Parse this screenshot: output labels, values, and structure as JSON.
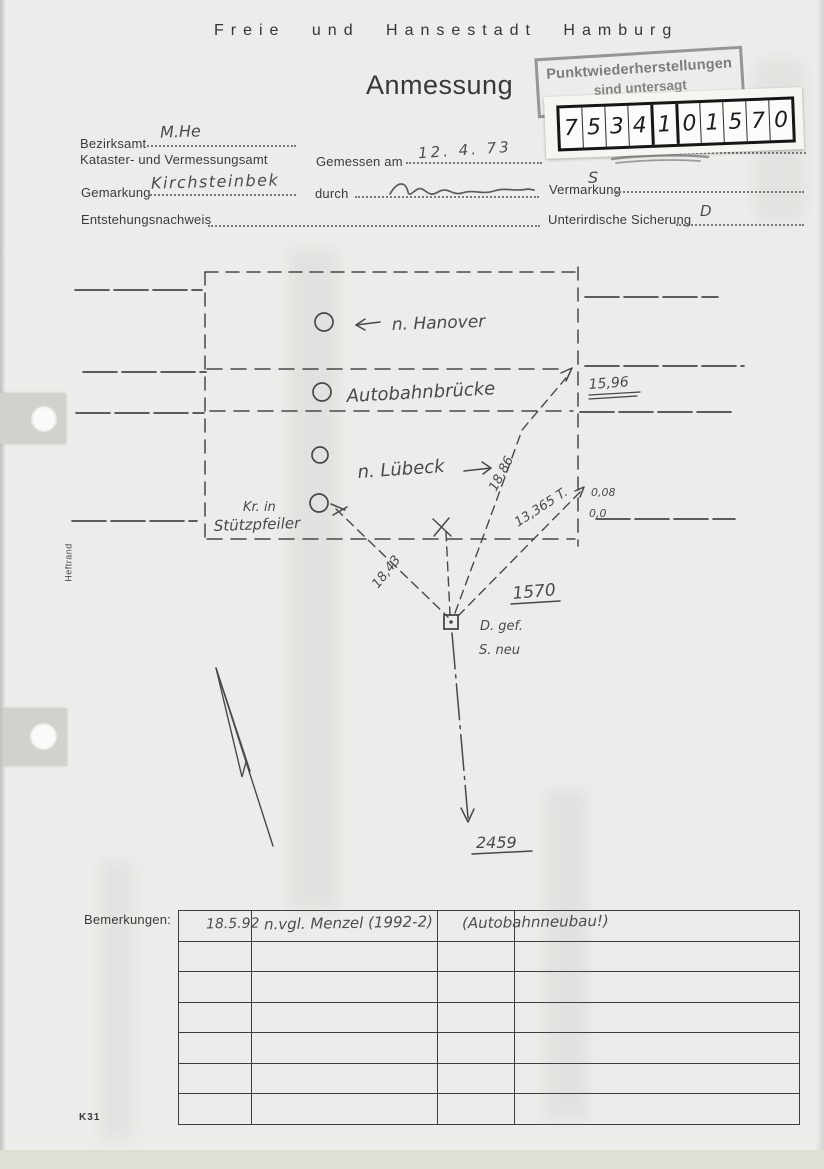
{
  "page": {
    "header": "Freie und Hansestadt Hamburg",
    "title": "Anmessung",
    "form_code": "K31",
    "margin_label": "Heftrand"
  },
  "colors": {
    "paper": "#ecedea",
    "printed_ink": "#3a3a3a",
    "pencil": "#4a4a4a",
    "stamp_ink": "#7c7c7c",
    "digit_label_bg": "#f5f5f1"
  },
  "stamp": {
    "line1": "Punktwiederherstellungen",
    "line2": "sind untersagt"
  },
  "point_number_label": {
    "caption": "Liniennetzpunkt Nr.",
    "digits": [
      "7",
      "5",
      "3",
      "4",
      "1",
      "0",
      "1",
      "5",
      "7",
      "0"
    ]
  },
  "form": {
    "bezirksamt_label": "Bezirksamt",
    "bezirksamt_value": "M.He",
    "amt_label": "Kataster- und Vermessungsamt",
    "gemessen_am_label": "Gemessen am",
    "gemessen_am_value": "12. 4. 73",
    "gemarkung_label": "Gemarkung",
    "gemarkung_value": "Kirchsteinbek",
    "durch_label": "durch",
    "entstehungsnachweis_label": "Entstehungsnachweis",
    "vermarkung_label": "Vermarkung",
    "vermarkung_value": "S",
    "sicherung_label": "Unterirdische Sicherung",
    "sicherung_value": "D"
  },
  "sketch": {
    "direction_left": "n. Hanover",
    "bridge": "Autobahnbrücke",
    "direction_right": "n. Lübeck",
    "pillar_line1": "Kr. in",
    "pillar_line2": "Stützpfeiler",
    "dist_corner": "15,96",
    "dist_mid": "18,86",
    "dist_right": "13,365 T.",
    "offset1": "0,08",
    "offset2": "0,0",
    "dist_left": "18,43",
    "point_number": "1570",
    "point_note1": "D. gef.",
    "point_note2": "S. neu",
    "target_point": "2459"
  },
  "remarks": {
    "label": "Bemerkungen:",
    "date": "18.5.92",
    "note": "n.vgl. Menzel (1992-2)",
    "note2": "(Autobahnneubau!)"
  }
}
